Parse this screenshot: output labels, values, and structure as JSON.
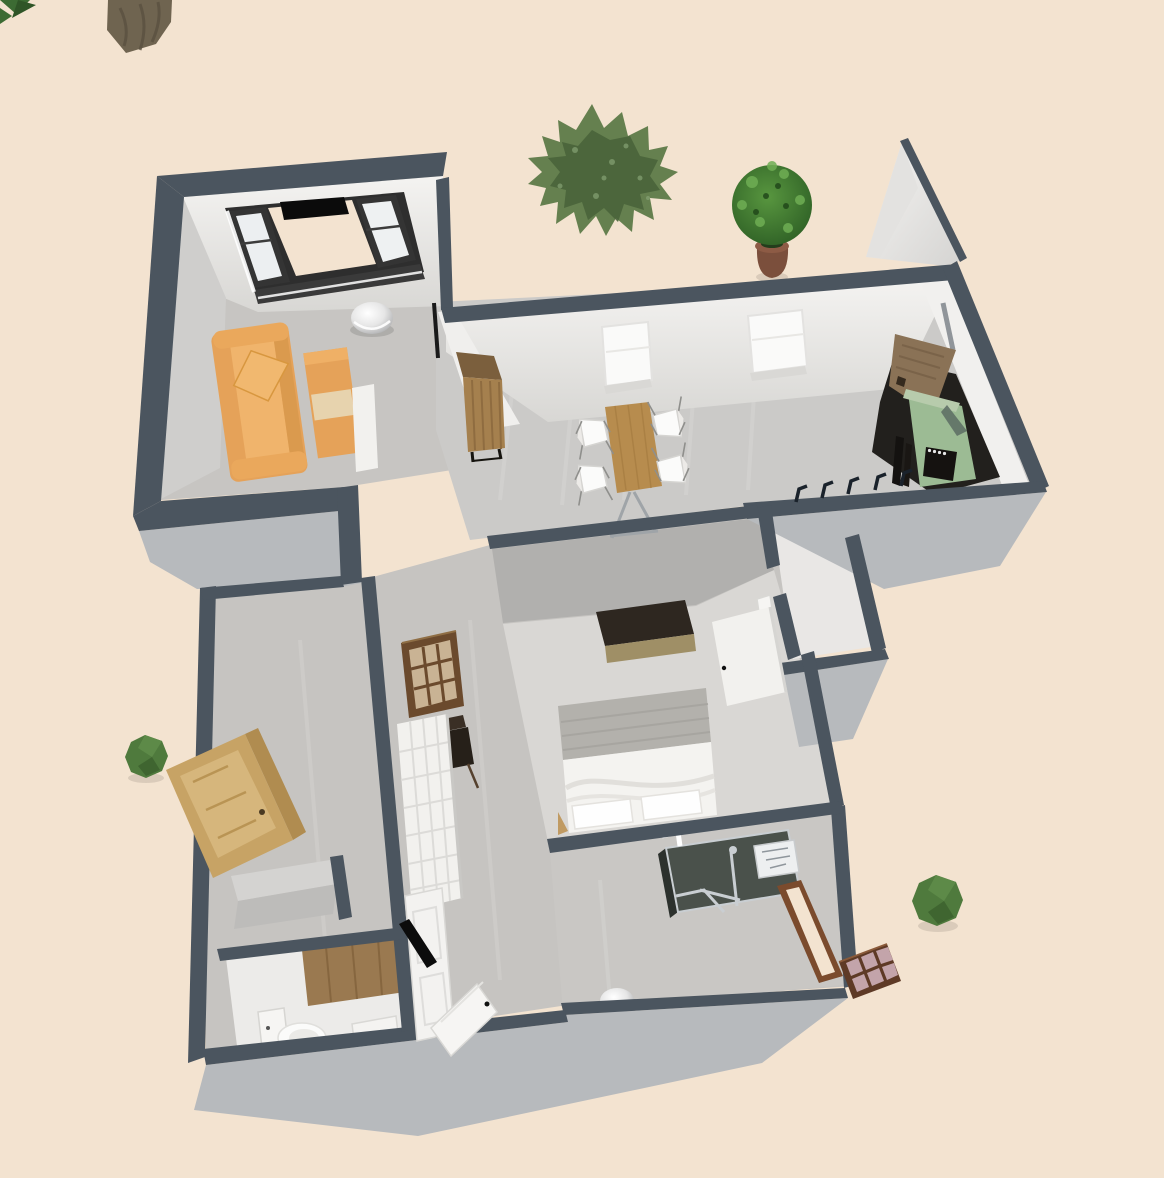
{
  "window": {
    "width": 1164,
    "height": 1178,
    "description": "3D aerial view of a furnished apartment floor plan rendered on a beige ground"
  },
  "colors": {
    "background": "#f3e3d0",
    "wall_dark": "#4b555f",
    "wall_outer": "#b7babd",
    "face_white": "#f1f0ee",
    "face_gray": "#cfcecc",
    "face_shadow": "#b1b0ae",
    "floor_living": "#c7c5c2",
    "floor_dining": "#cbcac8",
    "floor_bedroom": "#d9d7d4",
    "floor_hall": "#c6c4c1",
    "sofa": "#e5a259",
    "sofa_light": "#f0b46c",
    "bench_pad": "#e7d3ae",
    "wood_table": "#b78c4e",
    "wood_cabinet": "#a5804e",
    "door_tan": "#c7a365",
    "wood_dark": "#6b4a2d",
    "stove_green": "#9cbb94",
    "counter_dark": "#22201d",
    "chest_top": "#2e2720",
    "chest_front": "#9f8f66",
    "headboard": "#b3b1ac",
    "bed_white": "#f4f3f0",
    "white_obj": "#f2f1ee",
    "black": "#0c0c0c",
    "tree": "#5d7a48",
    "bush": "#4f7a3d",
    "pot": "#7b4f3c",
    "plant": "#3f7a33",
    "trunk": "#6f6450",
    "shower_glass": "#414842",
    "lattice_pane": "#c3a4aa",
    "silver": "#cfd3d6"
  },
  "scene": {
    "view": "top-down 3d perspective, no visible text or UI chrome",
    "outdoor_items": [
      {
        "name": "tree-trunk",
        "position": "top-left"
      },
      {
        "name": "corner-foliage",
        "position": "top-left corner"
      },
      {
        "name": "large-shrub-tree",
        "position": "top-center"
      },
      {
        "name": "potted-plant",
        "position": "outside above kitchen wall"
      },
      {
        "name": "round-bush-left",
        "position": "mid-left"
      },
      {
        "name": "round-bush-right",
        "position": "bottom-right"
      },
      {
        "name": "leaning-wood-door",
        "position": "outside left wall"
      },
      {
        "name": "lattice-window-panel",
        "position": "outside bathroom wall"
      }
    ],
    "rooms": [
      {
        "name": "living-room",
        "furniture": [
          "orange sofa with pillow",
          "orange bench ottoman",
          "white side panel",
          "glass dome lamp",
          "bay window with two dark-framed windows"
        ]
      },
      {
        "name": "dining-room",
        "furniture": [
          "wood dining table",
          "white chair x4",
          "tall wood bar cabinet",
          "wall window x2"
        ]
      },
      {
        "name": "kitchen",
        "furniture": [
          "green vintage stove",
          "dark counter",
          "open wood cabinet door",
          "stove pipe",
          "coat hooks on wall"
        ]
      },
      {
        "name": "closet",
        "furniture": [
          "white door frame"
        ]
      },
      {
        "name": "bedroom",
        "furniture": [
          "double bed with white duvet and two pillows",
          "dark chest",
          "open white door"
        ]
      },
      {
        "name": "bathroom",
        "furniture": [
          "dark glass shower enclosure",
          "washbasin",
          "brown door frame"
        ]
      },
      {
        "name": "wc",
        "furniture": [
          "toilet",
          "small washbasin",
          "wood floor strip"
        ]
      },
      {
        "name": "hallway",
        "furniture": [
          "dark armchair",
          "brown lattice window",
          "white grid panel",
          "gray storage block"
        ]
      },
      {
        "name": "entry",
        "furniture": [
          "open white front door",
          "closed white door panel",
          "black door wedge",
          "white floor dome lamp"
        ]
      }
    ]
  }
}
